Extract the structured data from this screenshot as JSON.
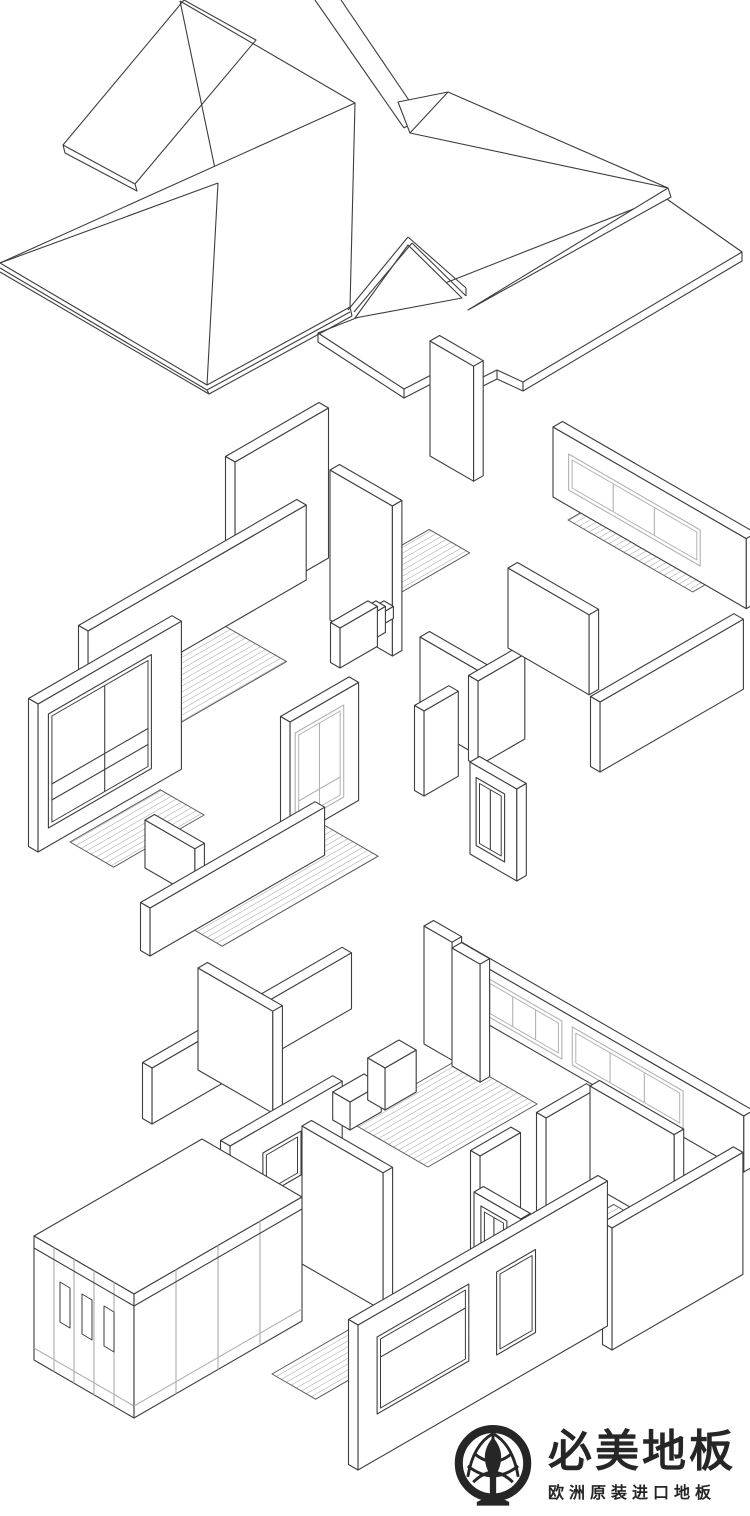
{
  "canvas": {
    "width": 750,
    "height": 1516,
    "background": "#ffffff"
  },
  "colors": {
    "line": "#3d3d3d",
    "light_line": "#b2b2b2",
    "hatch_line": "#a3a3a3",
    "floor_edge": "#5a5a5a",
    "logo_ink": "#262626"
  },
  "figures": {
    "roof": {
      "name": "exploded-roof-axonometric"
    },
    "upper_floor": {
      "name": "upper-floor-axonometric"
    },
    "ground_floor": {
      "name": "ground-floor-axonometric"
    }
  },
  "logo": {
    "brand": "必美地板",
    "tagline": "欧洲原装进口地板",
    "icon": "tree-in-circle-emblem-icon"
  }
}
